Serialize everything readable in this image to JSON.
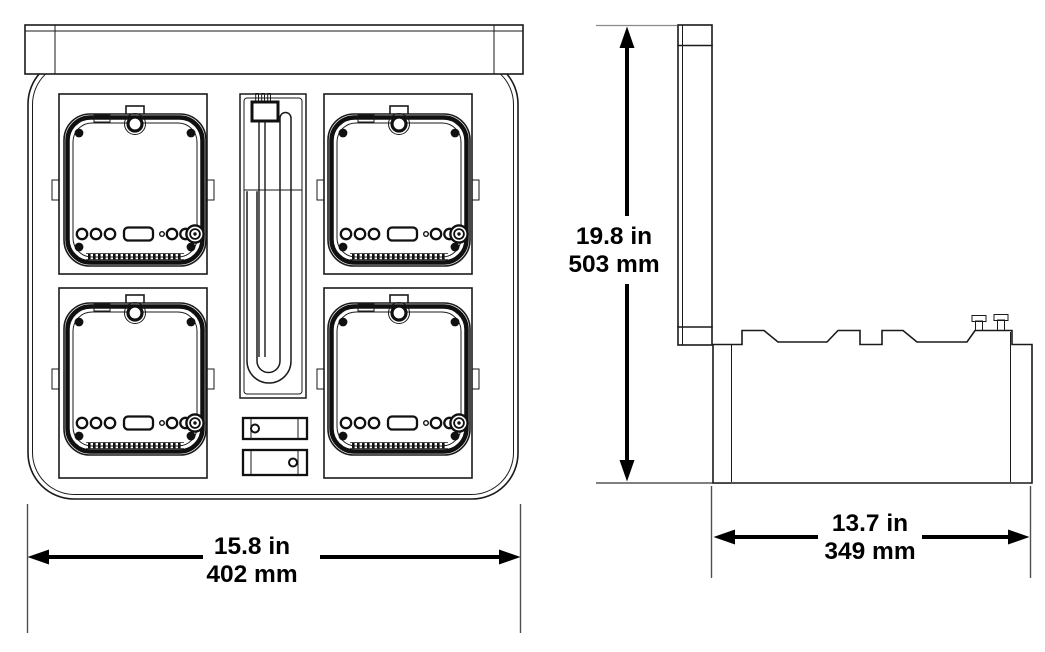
{
  "dimensions": {
    "width": {
      "imperial": "15.8 in",
      "metric": "402 mm"
    },
    "height": {
      "imperial": "19.8 in",
      "metric": "503 mm"
    },
    "depth": {
      "imperial": "13.7 in",
      "metric": "349 mm"
    }
  },
  "colors": {
    "line": "#1a1a1a",
    "extension_line": "#4f4f4f",
    "dimension_text": "#000000",
    "background": "#ffffff"
  }
}
